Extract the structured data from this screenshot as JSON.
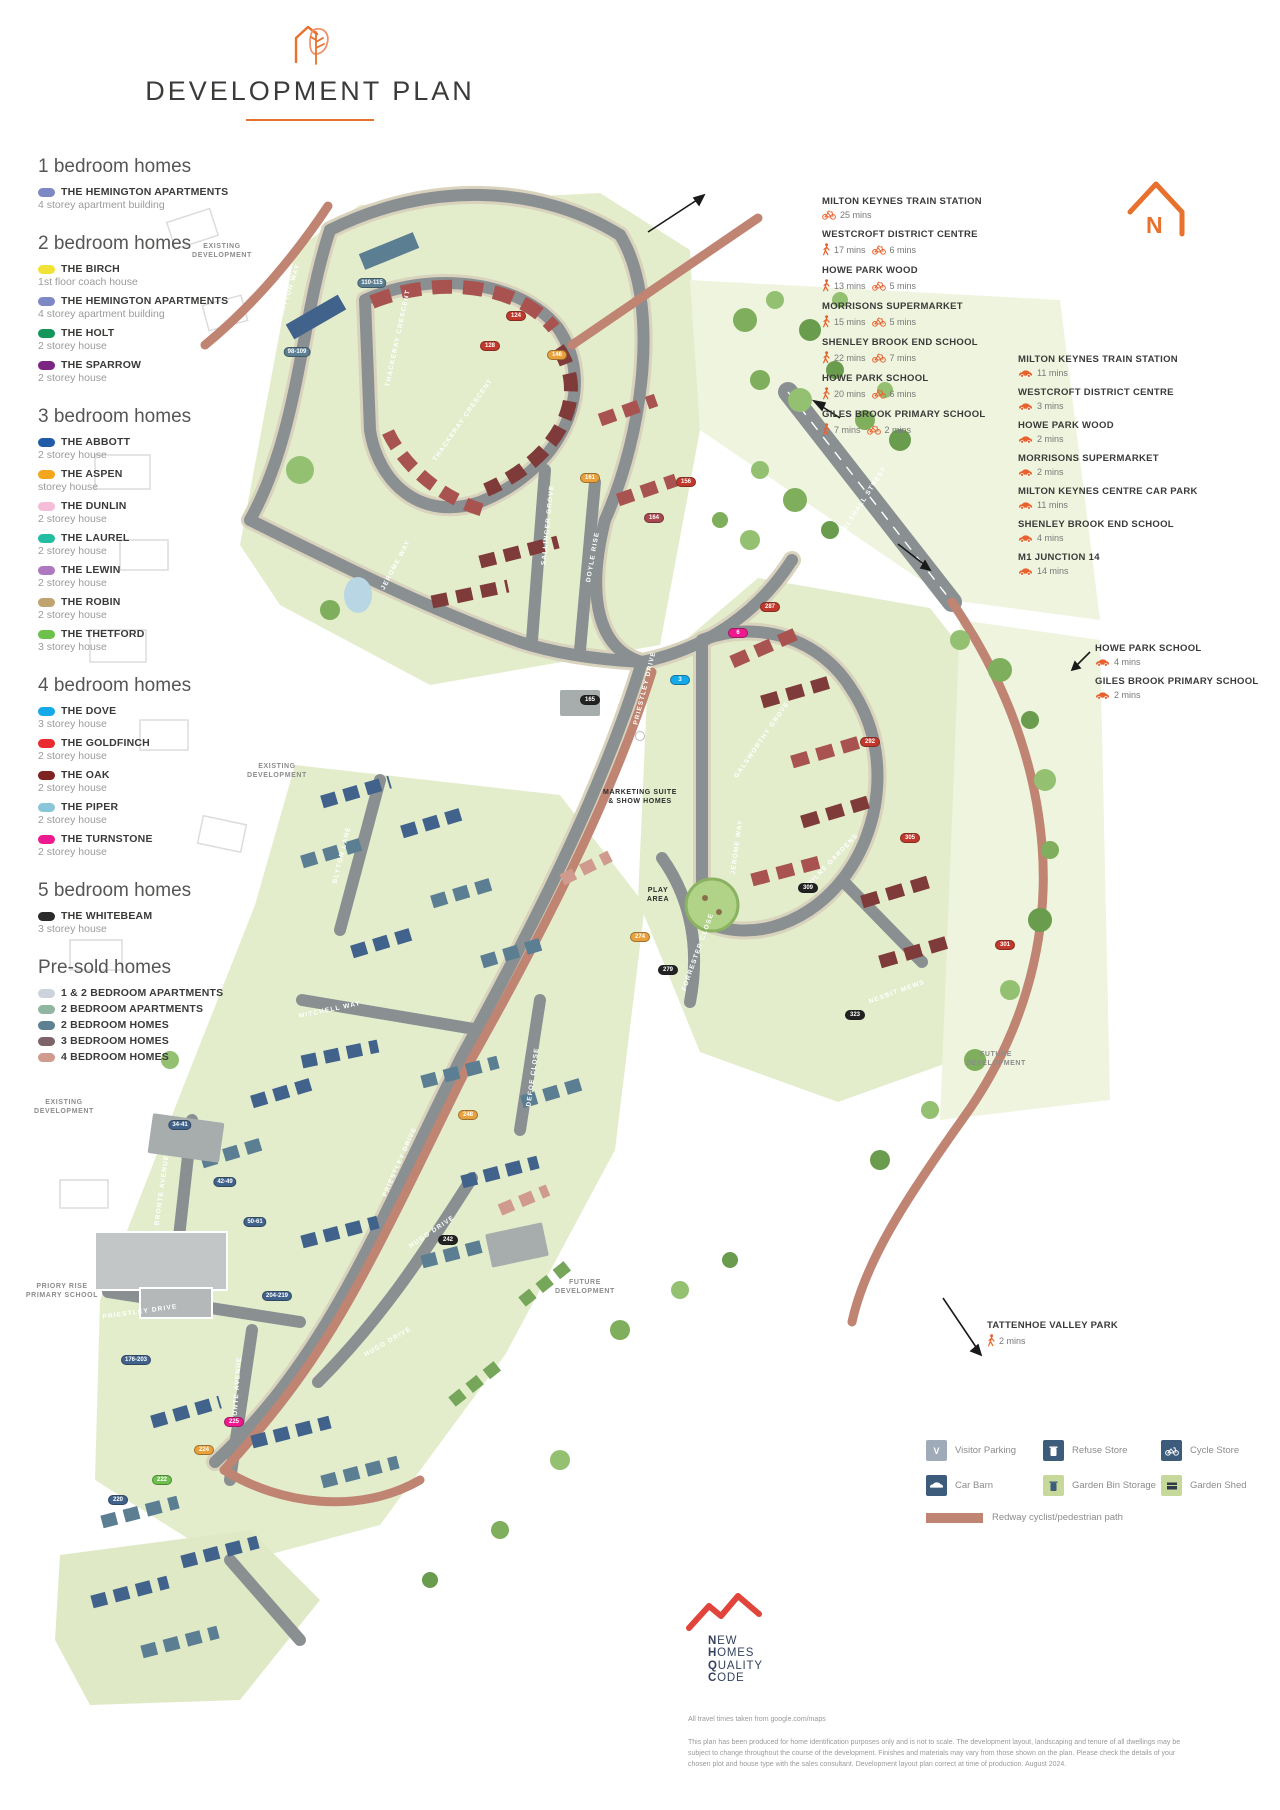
{
  "header": {
    "title": "DEVELOPMENT PLAN"
  },
  "north": {
    "label": "N"
  },
  "legend": {
    "sections": [
      {
        "heading": "1 bedroom homes",
        "items": [
          {
            "name": "THE HEMINGTON APARTMENTS",
            "desc": "4 storey apartment building",
            "color": "#7d88c4"
          }
        ]
      },
      {
        "heading": "2 bedroom homes",
        "items": [
          {
            "name": "THE BIRCH",
            "desc": "1st floor coach house",
            "color": "#f2e238"
          },
          {
            "name": "THE HEMINGTON APARTMENTS",
            "desc": "4 storey apartment building",
            "color": "#7d88c4"
          },
          {
            "name": "THE HOLT",
            "desc": "2 storey house",
            "color": "#14955c"
          },
          {
            "name": "THE SPARROW",
            "desc": "2 storey house",
            "color": "#7b2482"
          }
        ]
      },
      {
        "heading": "3 bedroom homes",
        "items": [
          {
            "name": "THE ABBOTT",
            "desc": "2 storey house",
            "color": "#1f5ba6"
          },
          {
            "name": "THE ASPEN",
            "desc": "storey house",
            "color": "#f4a71c"
          },
          {
            "name": "THE DUNLIN",
            "desc": "2 storey house",
            "color": "#f6bdd9"
          },
          {
            "name": "THE LAUREL",
            "desc": "2 storey house",
            "color": "#25bda2"
          },
          {
            "name": "THE LEWIN",
            "desc": "2 storey house",
            "color": "#b077c1"
          },
          {
            "name": "THE ROBIN",
            "desc": "2 storey house",
            "color": "#c0a36e"
          },
          {
            "name": "THE THETFORD",
            "desc": "3 storey house",
            "color": "#6ec04c"
          }
        ]
      },
      {
        "heading": "4 bedroom homes",
        "items": [
          {
            "name": "THE DOVE",
            "desc": "3 storey house",
            "color": "#15a9e9"
          },
          {
            "name": "THE GOLDFINCH",
            "desc": "2 storey house",
            "color": "#e92a2e"
          },
          {
            "name": "THE OAK",
            "desc": "2 storey house",
            "color": "#7e2321"
          },
          {
            "name": "THE PIPER",
            "desc": "2 storey house",
            "color": "#8ac6d9"
          },
          {
            "name": "THE TURNSTONE",
            "desc": "2 storey house",
            "color": "#ec1a8e"
          }
        ]
      },
      {
        "heading": "5 bedroom homes",
        "items": [
          {
            "name": "THE WHITEBEAM",
            "desc": "3 storey house",
            "color": "#2b2b2b"
          }
        ]
      },
      {
        "heading": "Pre-sold homes",
        "items": [
          {
            "name": "1 & 2 BEDROOM APARTMENTS",
            "desc": "",
            "color": "#ccd3dd"
          },
          {
            "name": "2 BEDROOM APARTMENTS",
            "desc": "",
            "color": "#90b6a2"
          },
          {
            "name": "2 BEDROOM HOMES",
            "desc": "",
            "color": "#5d8092"
          },
          {
            "name": "3 BEDROOM HOMES",
            "desc": "",
            "color": "#7c6469"
          },
          {
            "name": "4 BEDROOM HOMES",
            "desc": "",
            "color": "#d09a8e"
          }
        ]
      }
    ]
  },
  "travel": {
    "walk_cycle_block": [
      {
        "name": "MILTON KEYNES TRAIN STATION",
        "times": [
          {
            "mode": "cycle",
            "label": "25 mins"
          }
        ]
      },
      {
        "name": "WESTCROFT DISTRICT CENTRE",
        "times": [
          {
            "mode": "walk",
            "label": "17 mins"
          },
          {
            "mode": "cycle",
            "label": "6 mins"
          }
        ]
      },
      {
        "name": "HOWE PARK WOOD",
        "times": [
          {
            "mode": "walk",
            "label": "13 mins"
          },
          {
            "mode": "cycle",
            "label": "5 mins"
          }
        ]
      },
      {
        "name": "MORRISONS SUPERMARKET",
        "times": [
          {
            "mode": "walk",
            "label": "15 mins"
          },
          {
            "mode": "cycle",
            "label": "5 mins"
          }
        ]
      },
      {
        "name": "SHENLEY BROOK END SCHOOL",
        "times": [
          {
            "mode": "walk",
            "label": "22 mins"
          },
          {
            "mode": "cycle",
            "label": "7 mins"
          }
        ]
      },
      {
        "name": "HOWE PARK SCHOOL",
        "times": [
          {
            "mode": "walk",
            "label": "20 mins"
          },
          {
            "mode": "cycle",
            "label": "6 mins"
          }
        ]
      },
      {
        "name": "GILES BROOK PRIMARY SCHOOL",
        "times": [
          {
            "mode": "walk",
            "label": "7 mins"
          },
          {
            "mode": "cycle",
            "label": "2 mins"
          }
        ]
      }
    ],
    "drive_block": [
      {
        "name": "MILTON KEYNES TRAIN STATION",
        "times": [
          {
            "mode": "car",
            "label": "11 mins"
          }
        ]
      },
      {
        "name": "WESTCROFT DISTRICT CENTRE",
        "times": [
          {
            "mode": "car",
            "label": "3 mins"
          }
        ]
      },
      {
        "name": "HOWE PARK WOOD",
        "times": [
          {
            "mode": "car",
            "label": "2 mins"
          }
        ]
      },
      {
        "name": "MORRISONS SUPERMARKET",
        "times": [
          {
            "mode": "car",
            "label": "2 mins"
          }
        ]
      },
      {
        "name": "MILTON KEYNES CENTRE CAR PARK",
        "times": [
          {
            "mode": "car",
            "label": "11 mins"
          }
        ]
      },
      {
        "name": "SHENLEY BROOK END SCHOOL",
        "times": [
          {
            "mode": "car",
            "label": "4 mins"
          }
        ]
      },
      {
        "name": "M1 JUNCTION 14",
        "times": [
          {
            "mode": "car",
            "label": "14 mins"
          }
        ]
      }
    ],
    "drive_block_2": [
      {
        "name": "HOWE PARK SCHOOL",
        "times": [
          {
            "mode": "car",
            "label": "4 mins"
          }
        ]
      },
      {
        "name": "GILES BROOK PRIMARY SCHOOL",
        "times": [
          {
            "mode": "car",
            "label": "2 mins"
          }
        ]
      }
    ],
    "park_block": [
      {
        "name": "TATTENHOE VALLEY PARK",
        "times": [
          {
            "mode": "walk",
            "label": "2 mins"
          }
        ]
      }
    ]
  },
  "map": {
    "street_labels": [
      {
        "text": "HAYTON WAY",
        "x": 290,
        "y": 290,
        "rot": -72
      },
      {
        "text": "THACKERAY CRESCENT",
        "x": 398,
        "y": 338,
        "rot": -78
      },
      {
        "text": "THACKERAY CRESCENT",
        "x": 463,
        "y": 420,
        "rot": -55
      },
      {
        "text": "JEROME WAY",
        "x": 396,
        "y": 565,
        "rot": -62
      },
      {
        "text": "SALLINGER GROVE",
        "x": 548,
        "y": 525,
        "rot": -84
      },
      {
        "text": "DOYLE RISE",
        "x": 593,
        "y": 557,
        "rot": -80
      },
      {
        "text": "PRIESTLEY DRIVE",
        "x": 645,
        "y": 688,
        "rot": -76
      },
      {
        "text": "SNELSHALL STREET",
        "x": 862,
        "y": 503,
        "rot": -57
      },
      {
        "text": "BLYTON LANE",
        "x": 342,
        "y": 855,
        "rot": -76
      },
      {
        "text": "MITCHELL WAY",
        "x": 330,
        "y": 1010,
        "rot": -12
      },
      {
        "text": "FORRESTER CLOSE",
        "x": 698,
        "y": 952,
        "rot": -70
      },
      {
        "text": "DEFOE CLOSE",
        "x": 533,
        "y": 1077,
        "rot": -82
      },
      {
        "text": "PRIESTLEY DRIVE",
        "x": 400,
        "y": 1162,
        "rot": -66
      },
      {
        "text": "BRONTE AVENUE",
        "x": 162,
        "y": 1190,
        "rot": -82
      },
      {
        "text": "HUGO DRIVE",
        "x": 432,
        "y": 1232,
        "rot": -34
      },
      {
        "text": "HUGO DRIVE",
        "x": 388,
        "y": 1342,
        "rot": -30
      },
      {
        "text": "BRONTE AVENUE",
        "x": 237,
        "y": 1392,
        "rot": -86
      },
      {
        "text": "PRIESTLEY DRIVE",
        "x": 140,
        "y": 1312,
        "rot": -8
      },
      {
        "text": "GALSWORTHY GROVE",
        "x": 762,
        "y": 740,
        "rot": -55
      },
      {
        "text": "JEROME WAY",
        "x": 737,
        "y": 847,
        "rot": -82
      },
      {
        "text": "MILNE GARDENS",
        "x": 833,
        "y": 860,
        "rot": -46
      },
      {
        "text": "NESBIT MEWS",
        "x": 897,
        "y": 992,
        "rot": -20
      }
    ],
    "area_labels": [
      {
        "text": "EXISTING\nDEVELOPMENT",
        "x": 222,
        "y": 242,
        "dark": false
      },
      {
        "text": "EXISTING\nDEVELOPMENT",
        "x": 277,
        "y": 762,
        "dark": false
      },
      {
        "text": "EXISTING\nDEVELOPMENT",
        "x": 64,
        "y": 1098,
        "dark": false
      },
      {
        "text": "FUTURE\nDEVELOPMENT",
        "x": 996,
        "y": 1050,
        "dark": false
      },
      {
        "text": "FUTURE\nDEVELOPMENT",
        "x": 585,
        "y": 1278,
        "dark": false
      },
      {
        "text": "PRIORY RISE\nPRIMARY SCHOOL",
        "x": 62,
        "y": 1282,
        "dark": false
      },
      {
        "text": "MARKETING SUITE\n& SHOW HOMES",
        "x": 640,
        "y": 788,
        "dark": true
      },
      {
        "text": "PLAY\nAREA",
        "x": 658,
        "y": 886,
        "dark": true
      }
    ],
    "plot_markers": [
      {
        "label": "110-115",
        "x": 372,
        "y": 283,
        "bg": "#5b7e92"
      },
      {
        "label": "98-109",
        "x": 297,
        "y": 352,
        "bg": "#5b7e92"
      },
      {
        "label": "124",
        "x": 516,
        "y": 316,
        "bg": "#c0392c"
      },
      {
        "label": "128",
        "x": 490,
        "y": 346,
        "bg": "#c0392c"
      },
      {
        "label": "146",
        "x": 557,
        "y": 355,
        "bg": "#e8a13c"
      },
      {
        "label": "156",
        "x": 686,
        "y": 482,
        "bg": "#c0392c"
      },
      {
        "label": "161",
        "x": 590,
        "y": 478,
        "bg": "#e8a13c"
      },
      {
        "label": "164",
        "x": 654,
        "y": 518,
        "bg": "#a8474f"
      },
      {
        "label": "165",
        "x": 590,
        "y": 700,
        "bg": "#222222"
      },
      {
        "label": "3",
        "x": 680,
        "y": 680,
        "bg": "#15a9e9"
      },
      {
        "label": "6",
        "x": 738,
        "y": 633,
        "bg": "#ec1a8e"
      },
      {
        "label": "287",
        "x": 770,
        "y": 607,
        "bg": "#c0392c"
      },
      {
        "label": "292",
        "x": 870,
        "y": 742,
        "bg": "#c0392c"
      },
      {
        "label": "305",
        "x": 910,
        "y": 838,
        "bg": "#c0392c"
      },
      {
        "label": "309",
        "x": 808,
        "y": 888,
        "bg": "#222222"
      },
      {
        "label": "301",
        "x": 1005,
        "y": 945,
        "bg": "#c0392c"
      },
      {
        "label": "323",
        "x": 855,
        "y": 1015,
        "bg": "#222222"
      },
      {
        "label": "274",
        "x": 640,
        "y": 937,
        "bg": "#e8a13c"
      },
      {
        "label": "279",
        "x": 668,
        "y": 970,
        "bg": "#222222"
      },
      {
        "label": "248",
        "x": 468,
        "y": 1115,
        "bg": "#e8a13c"
      },
      {
        "label": "242",
        "x": 448,
        "y": 1240,
        "bg": "#222222"
      },
      {
        "label": "34-41",
        "x": 180,
        "y": 1125,
        "bg": "#41638b"
      },
      {
        "label": "42-49",
        "x": 225,
        "y": 1182,
        "bg": "#41638b"
      },
      {
        "label": "50-61",
        "x": 255,
        "y": 1222,
        "bg": "#41638b"
      },
      {
        "label": "204-219",
        "x": 277,
        "y": 1296,
        "bg": "#41638b"
      },
      {
        "label": "176-203",
        "x": 136,
        "y": 1360,
        "bg": "#41638b"
      },
      {
        "label": "225",
        "x": 234,
        "y": 1422,
        "bg": "#ec1a8e"
      },
      {
        "label": "224",
        "x": 204,
        "y": 1450,
        "bg": "#e8a13c"
      },
      {
        "label": "222",
        "x": 162,
        "y": 1480,
        "bg": "#6ec04c"
      },
      {
        "label": "220",
        "x": 118,
        "y": 1500,
        "bg": "#41638b"
      }
    ]
  },
  "amenities": {
    "items": [
      {
        "label": "Visitor Parking",
        "icon": "visitor-parking-icon",
        "bg": "#9fabb8",
        "glyph": "V"
      },
      {
        "label": "Refuse Store",
        "icon": "refuse-store-icon",
        "bg": "#3d5c7c",
        "glyph": "bin"
      },
      {
        "label": "Cycle Store",
        "icon": "cycle-store-icon",
        "bg": "#3d5c7c",
        "glyph": "cycle"
      },
      {
        "label": "Car Barn",
        "icon": "car-barn-icon",
        "bg": "#3d5c7c",
        "glyph": "car"
      },
      {
        "label": "Garden Bin Storage",
        "icon": "garden-bin-storage-icon",
        "bg": "#c6d89a",
        "glyph": "bin-dark"
      },
      {
        "label": "Garden Shed",
        "icon": "garden-shed-icon",
        "bg": "#c6d89a",
        "glyph": "shed"
      }
    ],
    "redway_label": "Redway cyclist/pedestrian path"
  },
  "nhqc": {
    "lines": [
      "NEW",
      "HOMES",
      "QUALITY",
      "CODE"
    ]
  },
  "footer": {
    "note": "All travel times taken from google.com/maps",
    "para": "This plan has been produced for home identification purposes only and is not to scale. The development layout, landscaping and tenure of all dwellings may be subject to change throughout the course of the development. Finishes and materials may vary from those shown on the plan. Please check the details of your chosen plot and house type with the sales consultant. Development layout plan correct at time of production. August 2024."
  }
}
